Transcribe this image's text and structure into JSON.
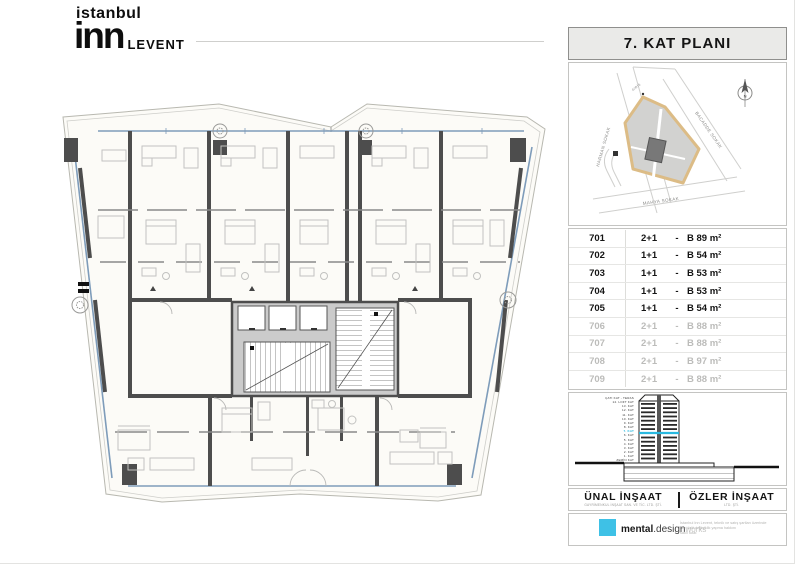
{
  "logo": {
    "line1": "istanbul",
    "line2": "inn",
    "suffix": "LEVENT"
  },
  "sidebar": {
    "title": "7. KAT PLANI",
    "map": {
      "streets": [
        {
          "name": "HARMAN SOKAK"
        },
        {
          "name": "BACADDE SOKAK"
        },
        {
          "name": "MAHYA SOKAK"
        }
      ],
      "entrance_label": "GİRİŞ",
      "north_label": "N",
      "parcel_border_color": "#dcbc86",
      "building_color": "#787878"
    },
    "units": {
      "separator": "-",
      "rows": [
        {
          "no": "701",
          "plan": "2+1",
          "size": "B 89 m²",
          "active": true
        },
        {
          "no": "702",
          "plan": "1+1",
          "size": "B 54 m²",
          "active": true
        },
        {
          "no": "703",
          "plan": "1+1",
          "size": "B 53 m²",
          "active": true
        },
        {
          "no": "704",
          "plan": "1+1",
          "size": "B 53 m²",
          "active": true
        },
        {
          "no": "705",
          "plan": "1+1",
          "size": "B 54 m²",
          "active": true
        },
        {
          "no": "706",
          "plan": "2+1",
          "size": "B 88 m²",
          "active": false
        },
        {
          "no": "707",
          "plan": "2+1",
          "size": "B 88 m²",
          "active": false
        },
        {
          "no": "708",
          "plan": "2+1",
          "size": "B 97 m²",
          "active": false
        },
        {
          "no": "709",
          "plan": "2+1",
          "size": "B 88 m²",
          "active": false
        }
      ]
    },
    "section": {
      "floors": [
        "ÇATI KAT - TERAS",
        "14. LOFT KAT",
        "13. KAT",
        "12. KAT",
        "11. KAT",
        "10. KAT",
        "9. KAT",
        "8. KAT",
        "7. KAT",
        "6. KAT",
        "5. KAT",
        "4. KAT",
        "3. KAT",
        "2. KAT",
        "1. KAT",
        "ZEMİN KAT"
      ],
      "highlight_floor": "7. KAT",
      "highlight_color": "#29b9e0"
    },
    "companies": [
      {
        "name": "ÜNAL İNŞAAT",
        "sub": "GAYRİMENKUL İNŞAAT SAN. VE TİC. LTD. ŞTİ."
      },
      {
        "name": "ÖZLER İNŞAAT",
        "sub": "LTD. ŞTİ."
      }
    ],
    "footer": {
      "brand_bold": "mental",
      "brand_mid": ".design",
      "brand_light": "works",
      "brand_color": "#3ec1e6",
      "disclaimer_lines": [
        "İstanbul Inn Levent, teknik ve satış şartları üzerinde",
        "her türlü değişiklik yapma hakkını",
        "saklı tutar."
      ]
    }
  }
}
